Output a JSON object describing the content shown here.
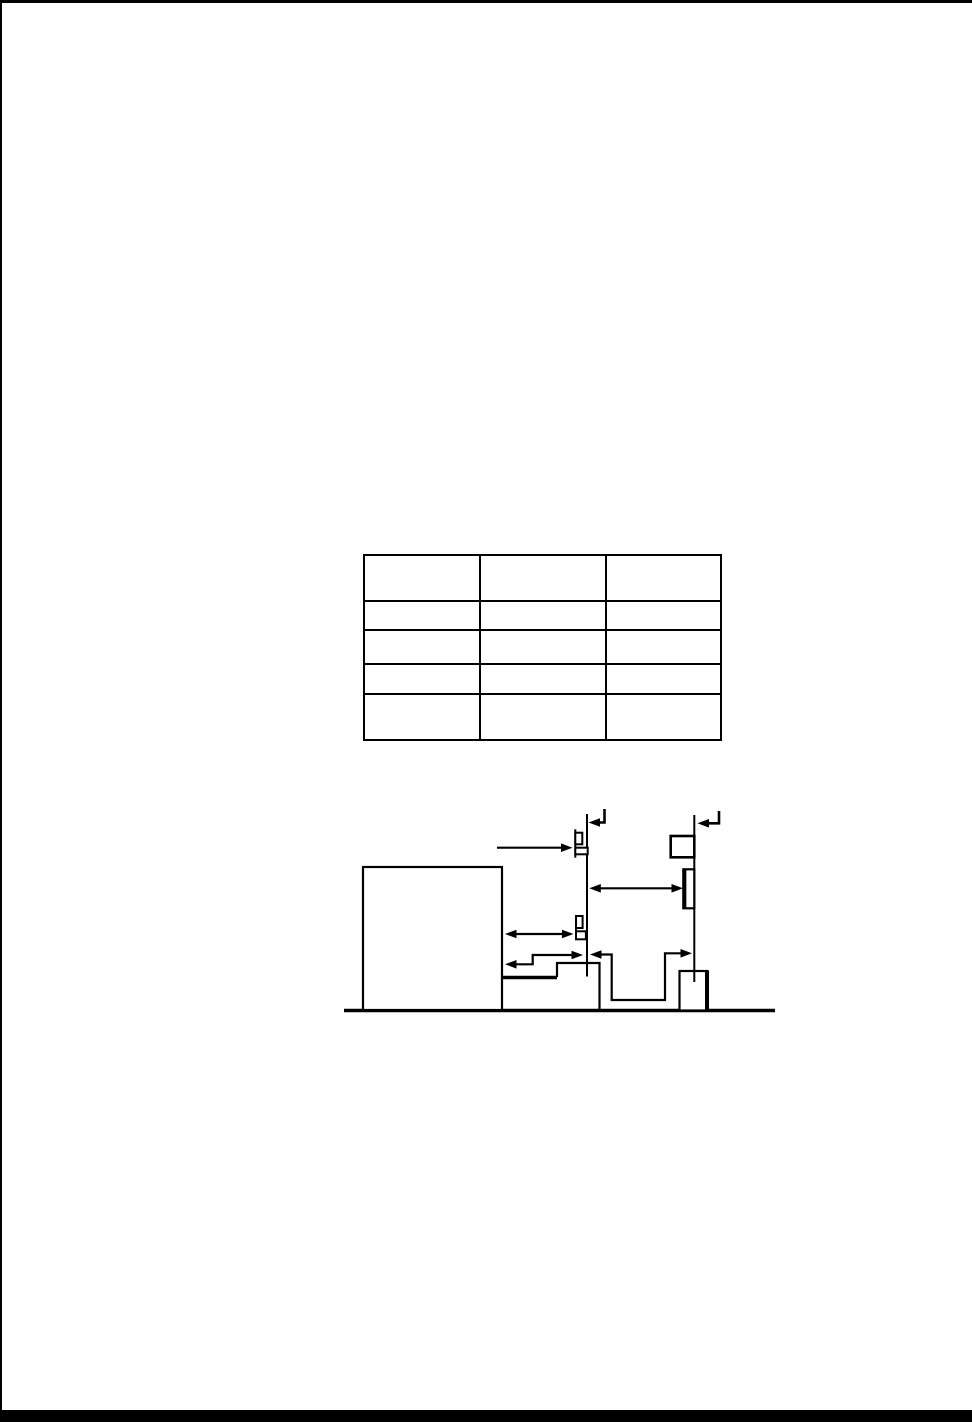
{
  "page": {
    "paper_color": "#ffffff",
    "ink_color": "#000000",
    "visible_text": "",
    "edges": [
      "top-border",
      "left-border",
      "bottom-thick-rule"
    ]
  },
  "table": {
    "rows": 5,
    "columns": 3,
    "cells": [
      [
        "",
        "",
        ""
      ],
      [
        "",
        "",
        ""
      ],
      [
        "",
        "",
        ""
      ],
      [
        "",
        "",
        ""
      ],
      [
        "",
        "",
        ""
      ]
    ]
  },
  "figure": {
    "type": "technical-line-diagram",
    "labels": [],
    "elements": [
      "ground-line",
      "large-box",
      "thick-shelf-line",
      "step-platform",
      "small-ground-box",
      "reference-line-1",
      "reference-line-2",
      "corner-hook-arrow-1",
      "corner-hook-arrow-2",
      "clamp-symbol-top",
      "clamp-symbol-middle",
      "box-on-line2-top",
      "tall-box-on-line2",
      "pointer-arrow",
      "dimension-arrow-a",
      "dimension-arrow-b",
      "jogged-dimension-c",
      "jogged-dimension-d"
    ]
  }
}
